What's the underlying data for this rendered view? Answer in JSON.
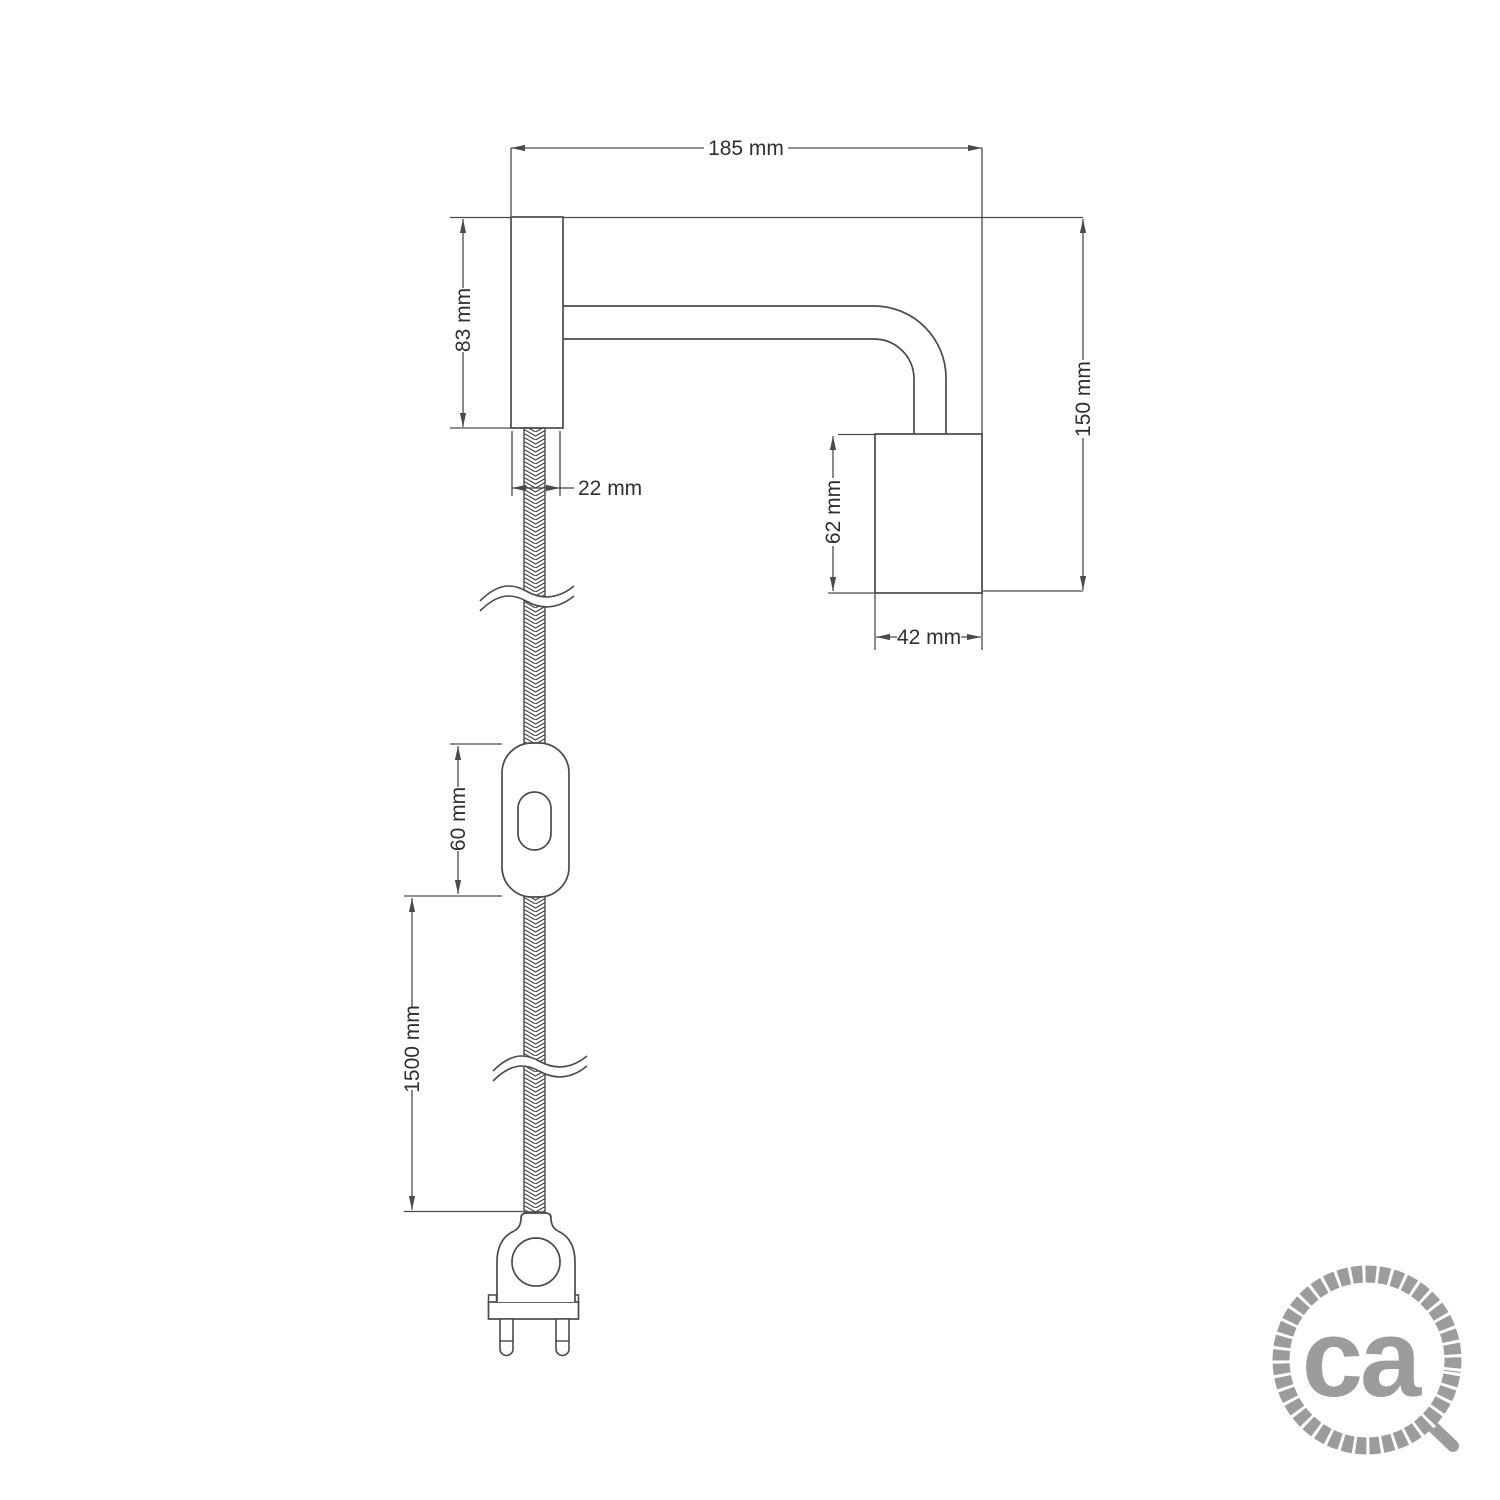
{
  "drawing": {
    "description": "Technical dimension drawing of a wall spotlight with elbow extension tube, cylindrical lamp holder, braided textile cable, inline switch and two-pin plug",
    "line_color": "#4a4a4a",
    "text_color": "#2f2f2f",
    "dimensions": {
      "total_width": "185 mm",
      "plate_height": "83 mm",
      "plate_depth": "22 mm",
      "holder_height": "62 mm",
      "holder_width": "42 mm",
      "total_height": "150 mm",
      "switch_length": "60 mm",
      "cable_length": "1500 mm"
    }
  },
  "logo": {
    "text": "ca",
    "color": "#9c9c9c"
  }
}
